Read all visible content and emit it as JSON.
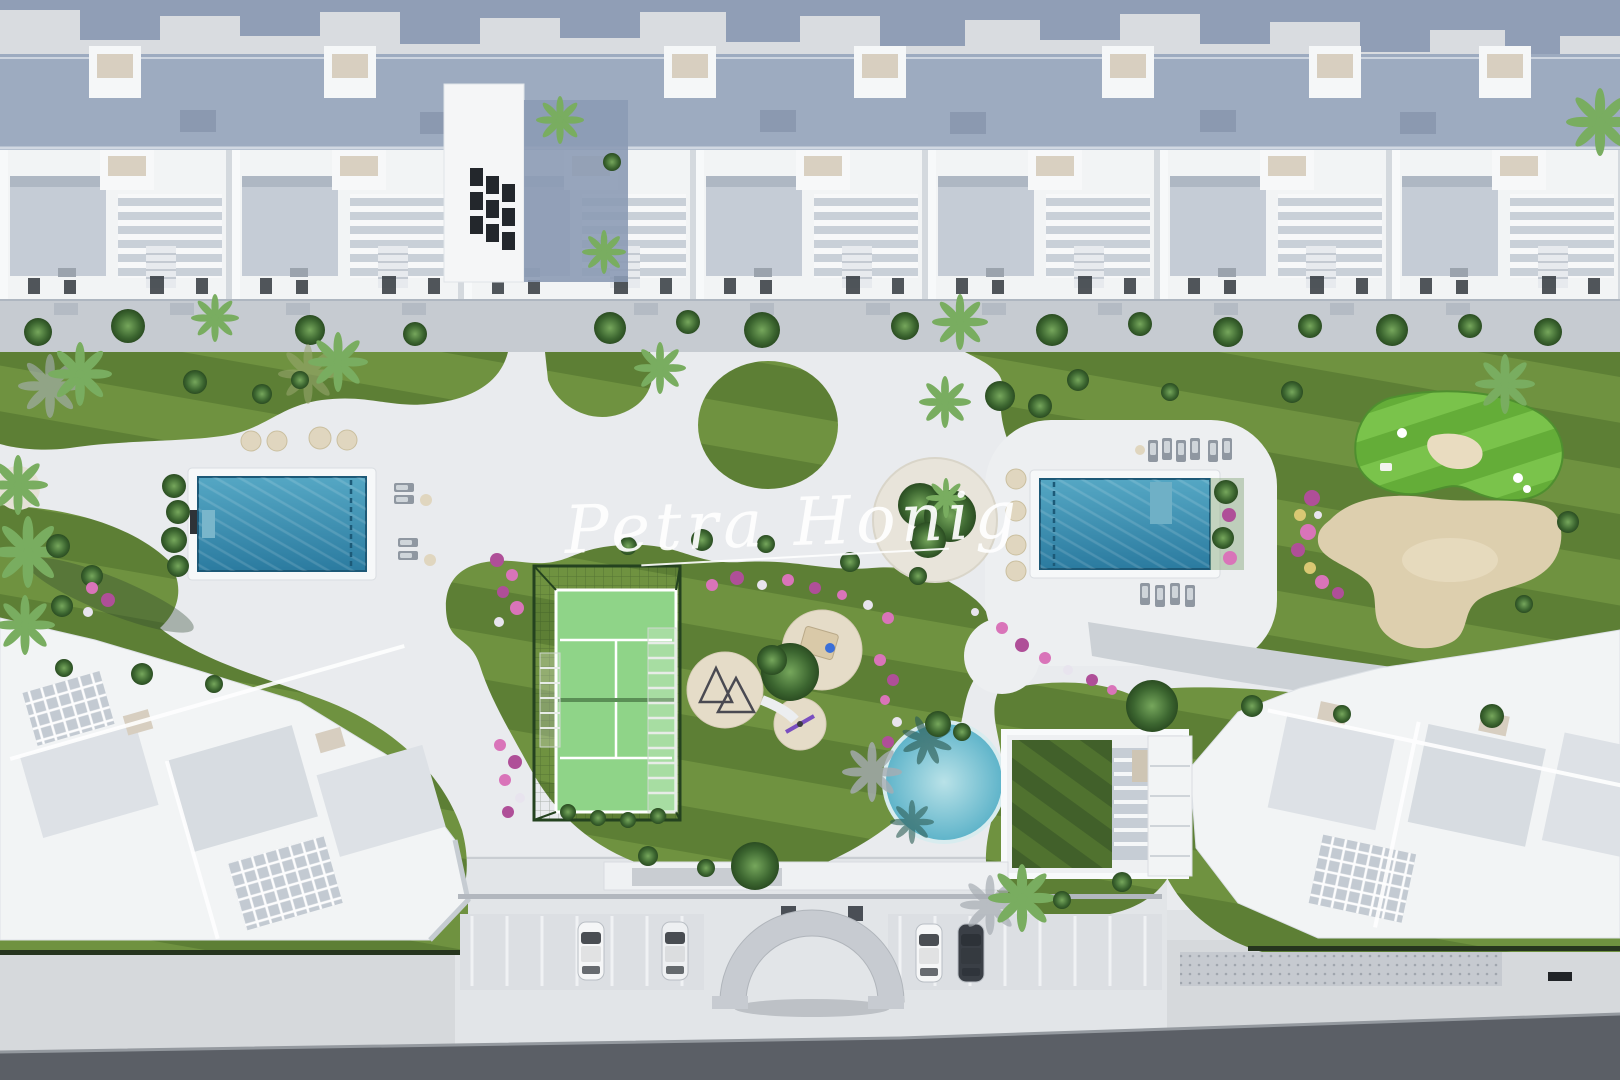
{
  "watermark": {
    "text": "Petra Honig"
  },
  "scene": {
    "type": "aerial-3d-render-residential-complex",
    "features": [
      "townhouse-roof-row",
      "garden-lawns",
      "lap-pool-left",
      "lap-pool-right",
      "padel-court",
      "playground",
      "round-lagoon-pool",
      "community-building",
      "putting-green",
      "sand-area",
      "flower-beds",
      "parking-bays",
      "entrance-arch",
      "street",
      "sun-loungers",
      "stepping-stones",
      "palm-trees"
    ],
    "counts": {
      "parked_cars": 4,
      "lap_pools": 2,
      "stepping_stones_left": 4,
      "stepping_stones_right": 4
    },
    "colors": {
      "pavement_top": "#d9dce0",
      "shadow_blue": "#8c9ab3",
      "roof_band": "#9dabc0",
      "building_white": "#f2f4f5",
      "terrace_gray": "#c5ccd6",
      "promenade": "#c6cbd1",
      "ground": "#e9ebee",
      "plaza": "#edeff1",
      "parking_zone": "#e2e5e8",
      "lawn_light": "#6f9240",
      "lawn_dark": "#5d7f35",
      "golf_light": "#7ac34b",
      "golf_dark": "#64ad38",
      "roof_lawn_light": "#50722f",
      "roof_lawn_dark": "#41602a",
      "pool_top": "#55a7c4",
      "pool_bottom": "#2b7ba0",
      "round_pool_center": "#b9e2e8",
      "round_pool_edge": "#5db3c9",
      "sand": "#ddcfae",
      "sand_light": "#e9dcc0",
      "stone": "#e0d6bf",
      "court_green": "#8fd488",
      "cage_green": "#24421f",
      "tree_mid": "#4a7a38",
      "palm_green": "#79ad60",
      "flower_pink": "#d974b9",
      "flower_magenta": "#af4f98",
      "flower_yellow": "#d9c873",
      "road": "#5b5f66",
      "sidewalk": "#d6d9dc",
      "arch_gray": "#c7cbd1",
      "car_dark": "#3a3f46",
      "watermark": "#ffffff"
    }
  }
}
